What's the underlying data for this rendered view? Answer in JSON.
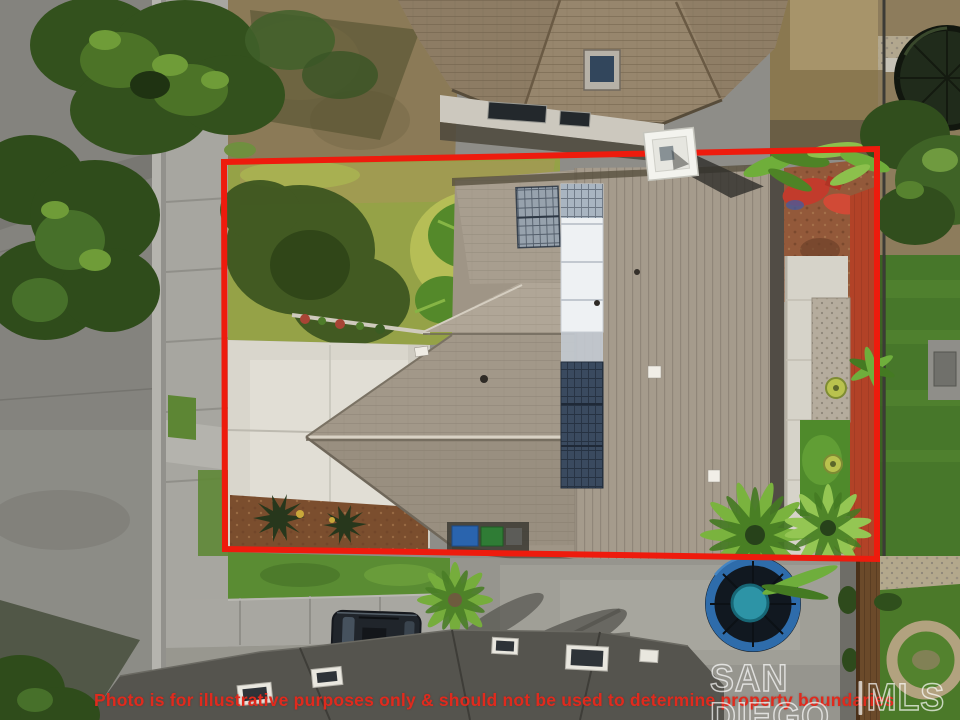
{
  "overlay": {
    "disclaimer": "Photo is for illustrative purposes only & should not be used to determine property boundaries",
    "watermark_left": "SAN DIEGO",
    "watermark_right": "MLS"
  },
  "colors": {
    "boundary_red": "#ee1b0d",
    "disclaimer_red": "#e02a1d",
    "watermark_white": "#ffffff"
  }
}
